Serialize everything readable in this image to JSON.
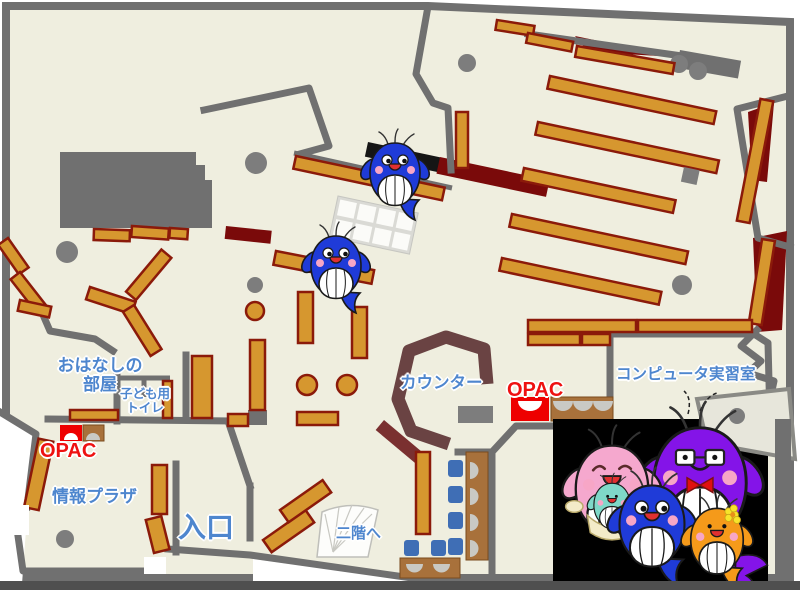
{
  "labels": {
    "storytelling_room": {
      "line1": "おはなしの",
      "line2": "部屋"
    },
    "kids_toilet": {
      "line1": "子ども用",
      "line2": "トイレ"
    },
    "opac_left": "OPAC",
    "opac_right": "OPAC",
    "info_plaza": "情報プラザ",
    "entrance": "入口",
    "counter": "カウンター",
    "computer_room": "コンピュータ実習室",
    "to_second_floor": "二階へ"
  },
  "colors": {
    "floor": "#EFEEDF",
    "wall_gray": "#707070",
    "shelf_tan": "#D6972F",
    "shelf_border": "#8B1A0A",
    "accent_dark_red": "#7A0A0A",
    "counter_brown": "#6A4343",
    "label_blue": "#4E86CE",
    "opac_red": "#EE1111",
    "opac_desk_red": "#EE0000",
    "chair_blue": "#3F6EB5",
    "desk_brown": "#A8713B",
    "photo_background": "#000000"
  },
  "icons": {
    "map_mascots": [
      "blue-whale",
      "blue-whale"
    ],
    "photo_mascots": [
      "pink-mother-whale",
      "purple-father-whale",
      "blue-child-whale",
      "orange-child-whale"
    ]
  }
}
